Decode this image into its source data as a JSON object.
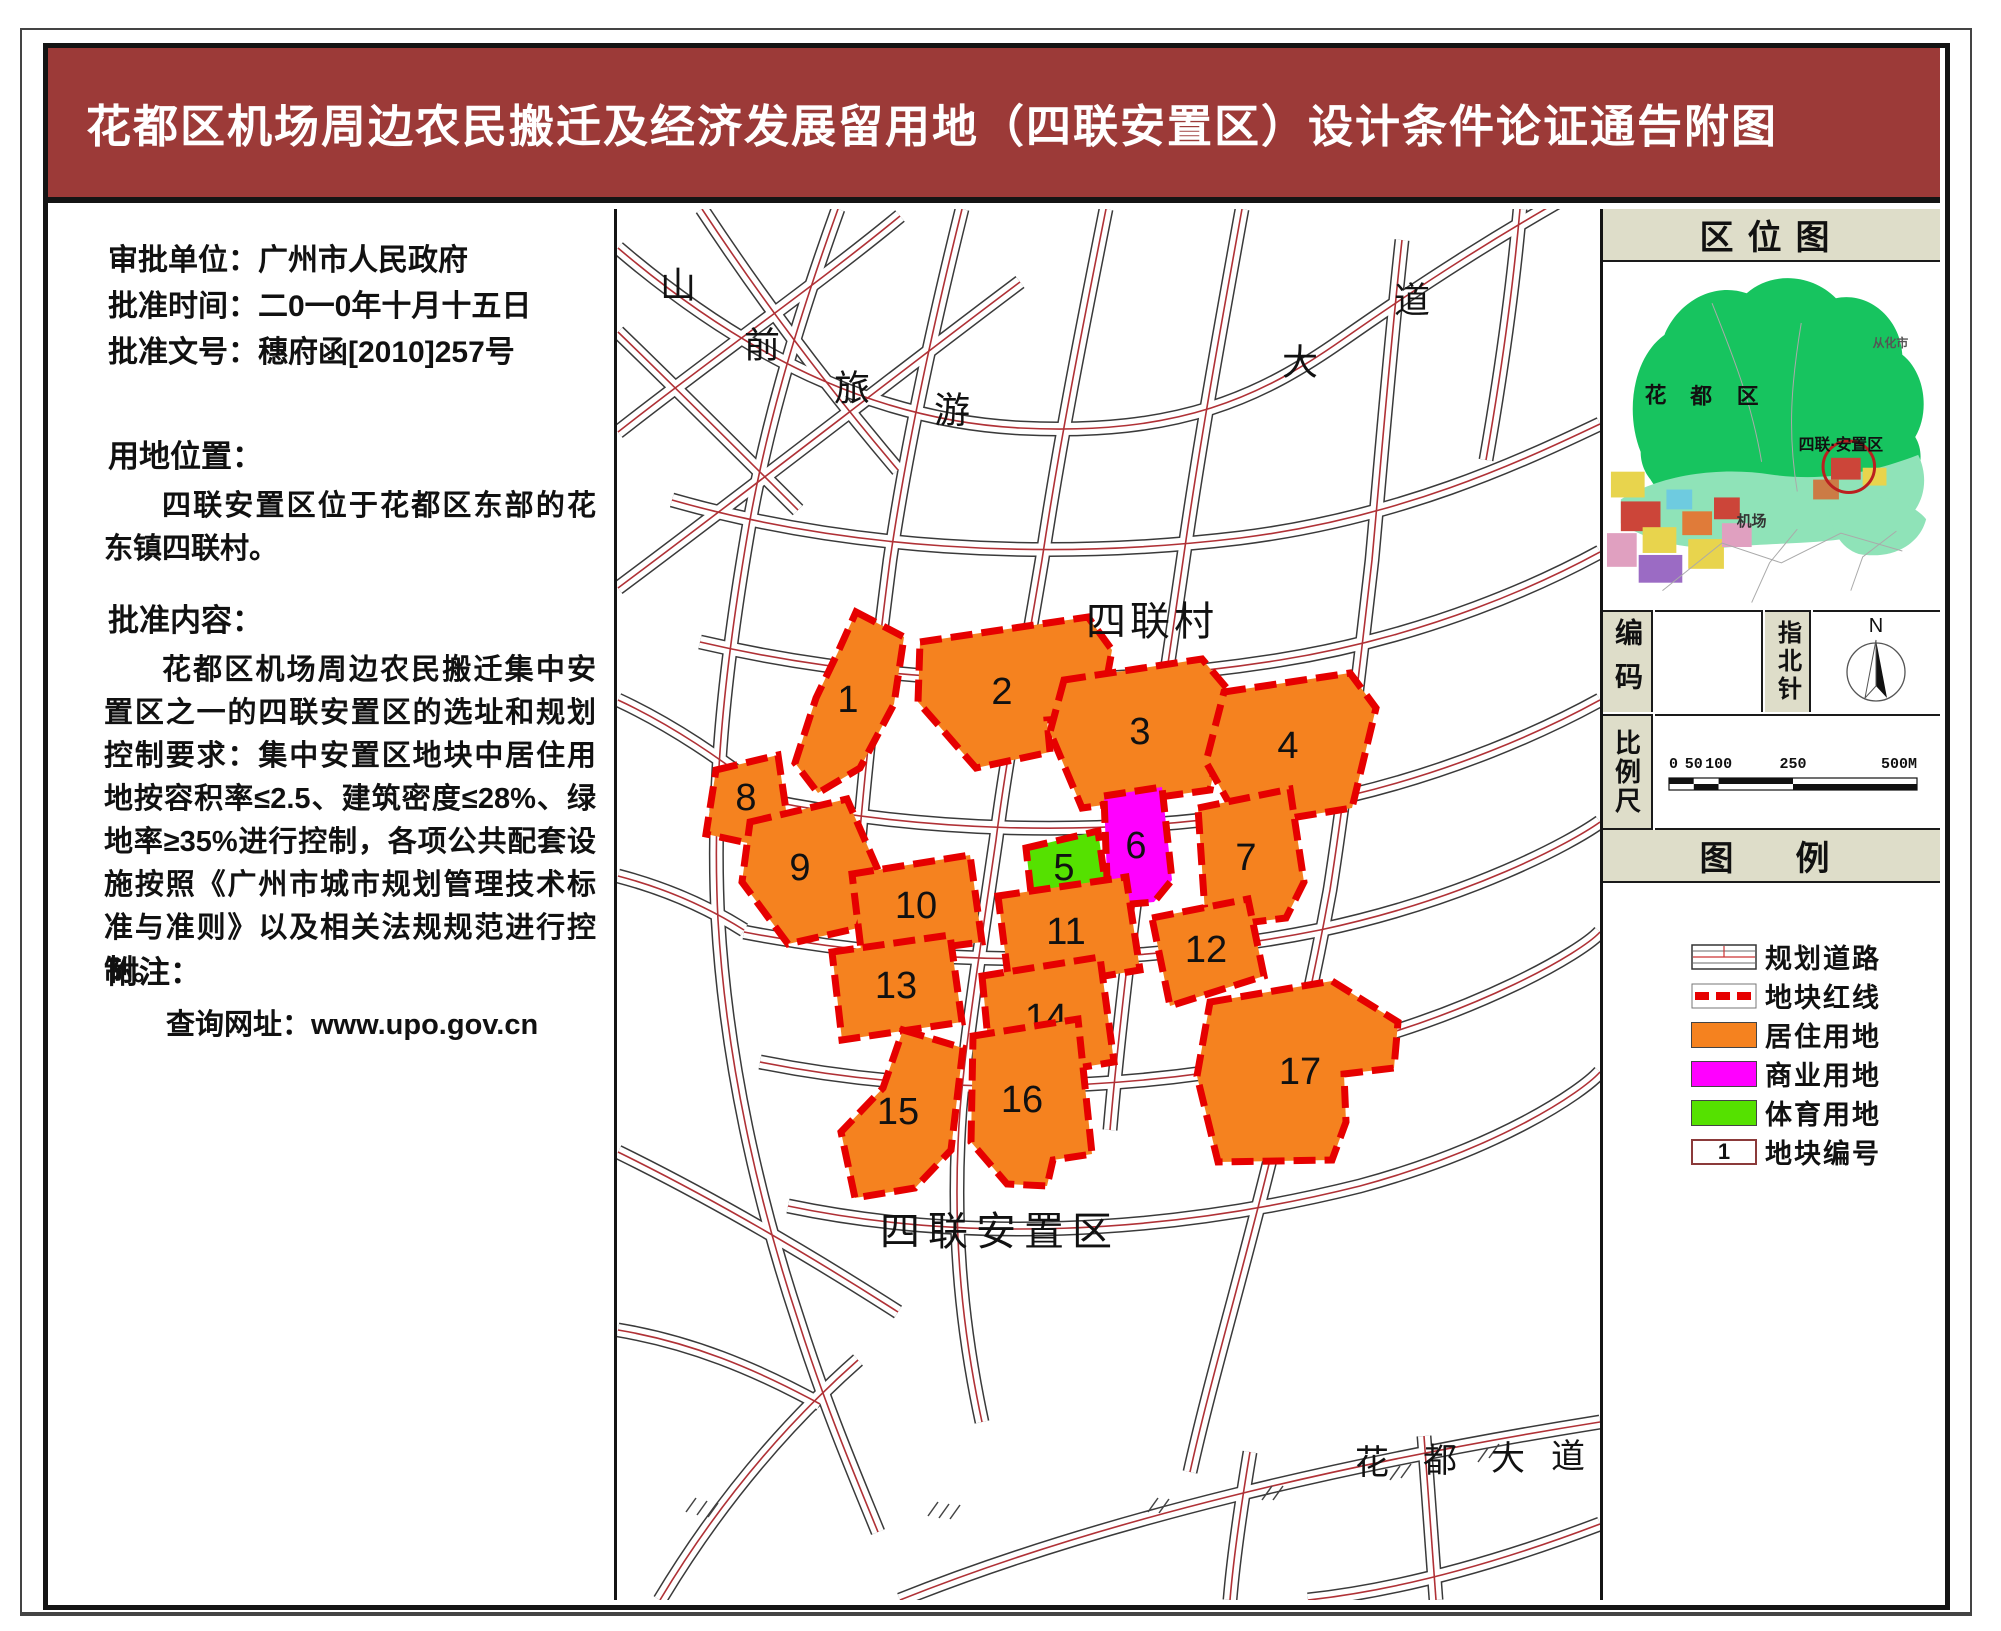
{
  "page": {
    "title": "花都区机场周边农民搬迁及经济发展留用地（四联安置区）设计条件论证通告附图"
  },
  "info_panel": {
    "approval_rows": [
      {
        "label": "审批单位：",
        "value": "广州市人民政府"
      },
      {
        "label": "批准时间：",
        "value": "二0一0年十月十五日"
      },
      {
        "label": "批准文号：",
        "value": "穗府函[2010]257号"
      }
    ],
    "location_heading": "用地位置：",
    "location_body": "四联安置区位于花都区东部的花东镇四联村。",
    "approval_heading": "批准内容：",
    "approval_body": "花都区机场周边农民搬迁集中安置区之一的四联安置区的选址和规划控制要求：集中安置区地块中居住用地按容积率≤2.5、建筑密度≤28%、绿地率≥35%进行控制，各项公共配套设施按照《广州市城市规划管理技术标准与准则》以及相关法规规范进行控制。",
    "notes_heading": "附注：",
    "notes_link": "查询网址：www.upo.gov.cn"
  },
  "map": {
    "road_name_chars": [
      {
        "text": "山",
        "x": 678,
        "y": 285
      },
      {
        "text": "前",
        "x": 762,
        "y": 345
      },
      {
        "text": "旅",
        "x": 852,
        "y": 388
      },
      {
        "text": "游",
        "x": 952,
        "y": 410
      },
      {
        "text": "大",
        "x": 1300,
        "y": 362
      },
      {
        "text": "道",
        "x": 1412,
        "y": 300
      }
    ],
    "labels": [
      {
        "text": "四联村",
        "x": 1152,
        "y": 622,
        "size": 40,
        "ls": 4
      },
      {
        "text": "四联安置区",
        "x": 1000,
        "y": 1232,
        "size": 40,
        "ls": 8
      },
      {
        "text": "花",
        "x": 1372,
        "y": 1463,
        "size": 34,
        "ls": 0
      },
      {
        "text": "都",
        "x": 1440,
        "y": 1461,
        "size": 34,
        "ls": 0
      },
      {
        "text": "大",
        "x": 1508,
        "y": 1459,
        "size": 34,
        "ls": 0
      },
      {
        "text": "道",
        "x": 1568,
        "y": 1457,
        "size": 34,
        "ls": 0
      }
    ],
    "parcels": [
      {
        "id": "1",
        "type": "residential",
        "cx": 848,
        "cy": 700,
        "points": "856,612 904,637 894,704 860,768 818,793 795,763 816,698 838,652"
      },
      {
        "id": "2",
        "type": "residential",
        "cx": 1002,
        "cy": 692,
        "points": "920,642 1088,617 1112,650 1100,716 1047,720 1050,752 976,768 918,702"
      },
      {
        "id": "3",
        "type": "residential",
        "cx": 1140,
        "cy": 732,
        "points": "1064,680 1202,659 1230,692 1210,790 1082,808 1050,732"
      },
      {
        "id": "4",
        "type": "residential",
        "cx": 1288,
        "cy": 746,
        "points": "1224,692 1350,673 1376,708 1352,808 1242,826 1206,762"
      },
      {
        "id": "5",
        "type": "sports",
        "cx": 1064,
        "cy": 868,
        "points": "1026,848 1098,831 1106,888 1032,902"
      },
      {
        "id": "6",
        "type": "commercial",
        "cx": 1136,
        "cy": 846,
        "points": "1104,796 1162,787 1172,880 1154,902 1108,906"
      },
      {
        "id": "7",
        "type": "residential",
        "cx": 1246,
        "cy": 858,
        "points": "1198,808 1290,789 1304,882 1286,918 1206,928"
      },
      {
        "id": "8",
        "type": "residential",
        "cx": 746,
        "cy": 798,
        "points": "716,770 778,755 788,824 752,844 706,834"
      },
      {
        "id": "9",
        "type": "residential",
        "cx": 800,
        "cy": 868,
        "points": "750,822 847,799 878,870 858,928 788,944 742,882"
      },
      {
        "id": "10",
        "type": "residential",
        "cx": 916,
        "cy": 906,
        "points": "852,874 970,855 982,942 862,958"
      },
      {
        "id": "11",
        "type": "residential",
        "cx": 1066,
        "cy": 932,
        "points": "998,896 1126,877 1140,970 1010,992"
      },
      {
        "id": "12",
        "type": "residential",
        "cx": 1206,
        "cy": 950,
        "points": "1152,918 1248,899 1264,976 1170,1006"
      },
      {
        "id": "13",
        "type": "residential",
        "cx": 896,
        "cy": 986,
        "points": "832,952 950,935 962,1022 842,1040"
      },
      {
        "id": "14",
        "type": "residential",
        "cx": 1046,
        "cy": 1018,
        "points": "982,976 1100,957 1114,1062 992,1082"
      },
      {
        "id": "15",
        "type": "residential",
        "cx": 898,
        "cy": 1112,
        "points": "903,1030 963,1048 951,1150 915,1188 855,1198 841,1132 883,1088"
      },
      {
        "id": "16",
        "type": "residential",
        "cx": 1022,
        "cy": 1100,
        "points": "973,1036 1078,1019 1092,1154 1053,1160 1047,1186 1007,1184 971,1142"
      },
      {
        "id": "17",
        "type": "residential",
        "cx": 1300,
        "cy": 1072,
        "points": "1210,1002 1332,981 1398,1022 1394,1068 1344,1074 1346,1122 1332,1160 1218,1162 1197,1076"
      }
    ]
  },
  "right_panel": {
    "location_map_title": "区位图",
    "minimap_labels": [
      {
        "text": "花",
        "x": 53,
        "y": 140,
        "size": 22,
        "color": "#111"
      },
      {
        "text": "都",
        "x": 99,
        "y": 141,
        "size": 22,
        "color": "#111"
      },
      {
        "text": "区",
        "x": 146,
        "y": 141,
        "size": 22,
        "color": "#111"
      },
      {
        "text": "四联·安置区",
        "x": 240,
        "y": 188,
        "size": 16,
        "color": "#111"
      },
      {
        "text": "机场",
        "x": 150,
        "y": 265,
        "size": 15,
        "color": "#333"
      },
      {
        "text": "从化市",
        "x": 290,
        "y": 84,
        "size": 12,
        "color": "#555"
      }
    ],
    "code_label": "编码",
    "compass_label": "指北针",
    "compass_north": "N",
    "scale_label": "比例尺",
    "scale_bar": {
      "max": 500,
      "ticks": [
        {
          "label": "0",
          "v": 0
        },
        {
          "label": "50",
          "v": 50
        },
        {
          "label": "100",
          "v": 100
        },
        {
          "label": "250",
          "v": 250
        },
        {
          "label": "500M",
          "v": 500
        }
      ]
    },
    "legend_title": "图　例",
    "legend_items": [
      {
        "key": "road",
        "label": "规划道路"
      },
      {
        "key": "redline",
        "label": "地块红线"
      },
      {
        "key": "residential",
        "label": "居住用地"
      },
      {
        "key": "commercial",
        "label": "商业用地"
      },
      {
        "key": "sports",
        "label": "体育用地"
      },
      {
        "key": "number",
        "label": "地块编号",
        "sample": "1"
      }
    ]
  },
  "colors": {
    "header": "#9C3A38",
    "panel_beige": "#DEDDC9",
    "residential": "#F5821F",
    "commercial": "#FF00FF",
    "sports": "#55E100",
    "redline": "#E60000",
    "road_center": "#B03136"
  }
}
